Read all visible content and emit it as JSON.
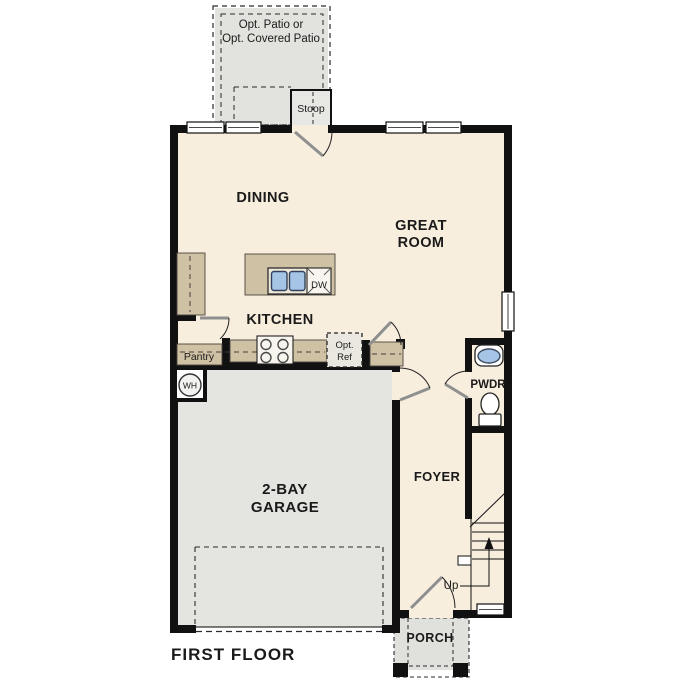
{
  "floor_plan": {
    "title": "FIRST FLOOR",
    "rooms": {
      "dining": "DINING",
      "great_room_line1": "GREAT",
      "great_room_line2": "ROOM",
      "kitchen": "KITCHEN",
      "garage_line1": "2-BAY",
      "garage_line2": "GARAGE",
      "foyer": "FOYER",
      "powder_room": "PWDR",
      "porch": "PORCH",
      "pantry": "Pantry",
      "stoop": "Stoop"
    },
    "optional_features": {
      "patio_line1": "Opt. Patio or",
      "patio_line2": "Opt. Covered Patio",
      "opt_ref_line1": "Opt.",
      "opt_ref_line2": "Ref"
    },
    "fixtures": {
      "dishwasher": "DW",
      "water_heater": "WH"
    },
    "annotations": {
      "stairs_up": "Up"
    }
  },
  "colors": {
    "wall": "#111111",
    "interior": "#f7eedd",
    "cabinet": "#cfc1a4",
    "garage": "#e4e4e0",
    "patio": "#e2e2de",
    "stoop": "#e7e7e3",
    "porch": "#e0e0dc",
    "opt_ref_fill": "#e9e7df",
    "appliance": "#f8f5ee",
    "sink_blue": "#a5c4e6",
    "text": "#1a1a1a"
  }
}
